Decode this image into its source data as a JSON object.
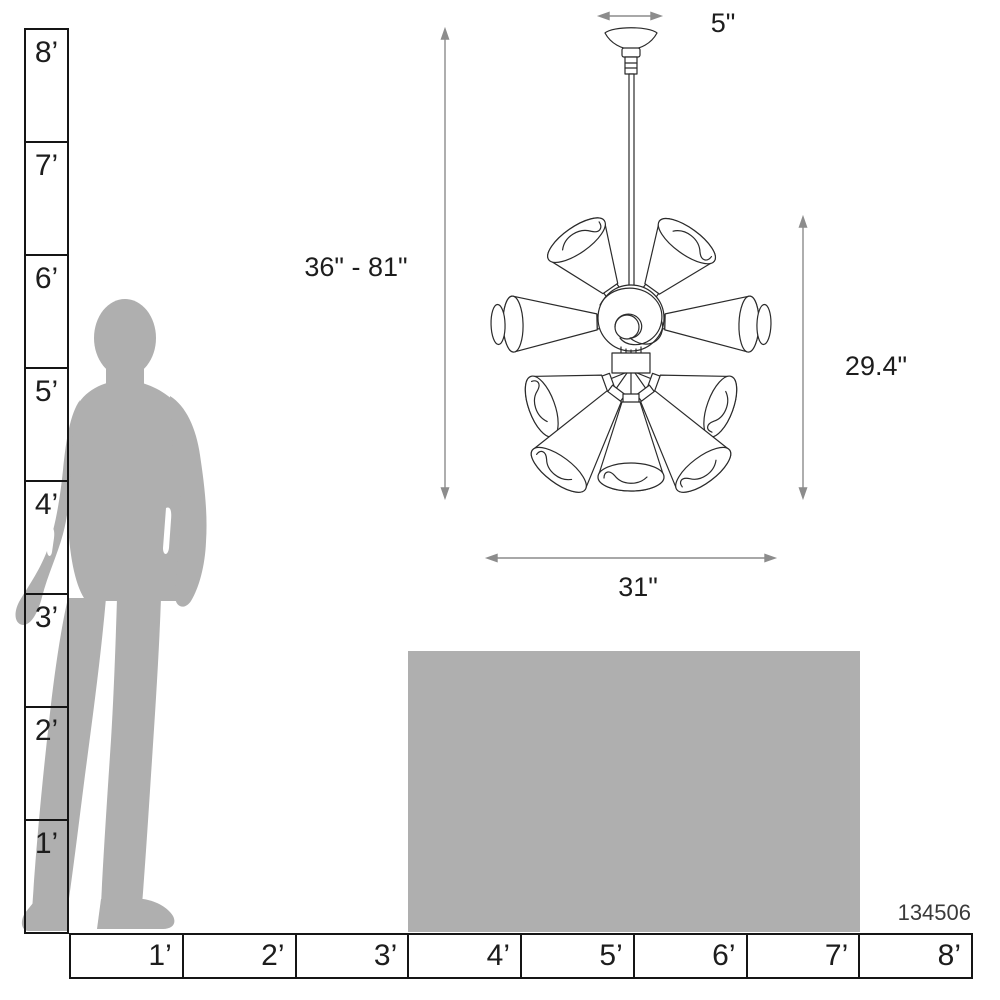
{
  "product": {
    "code": "134506"
  },
  "dimensions": {
    "canopy_width": "5\"",
    "hanging_height": "36\" - 81\"",
    "fixture_height": "29.4\"",
    "fixture_width": "31\""
  },
  "rulers": {
    "unit": "feet",
    "vertical": {
      "labels": [
        "8’",
        "7’",
        "6’",
        "5’",
        "4’",
        "3’",
        "2’",
        "1’"
      ]
    },
    "horizontal": {
      "labels": [
        "1’",
        "2’",
        "3’",
        "4’",
        "5’",
        "6’",
        "7’",
        "8’"
      ]
    }
  },
  "figure": {
    "person": "standing-man-silhouette-for-scale",
    "furniture": "table-silhouette-4ft-wide",
    "fixture": "sputnik-chandelier-line-drawing"
  },
  "colors": {
    "silhouette": "#afafaf",
    "line_art": "#2b2b2b",
    "dimension_lines": "#8c8c8c",
    "ruler_lines": "#151515"
  }
}
